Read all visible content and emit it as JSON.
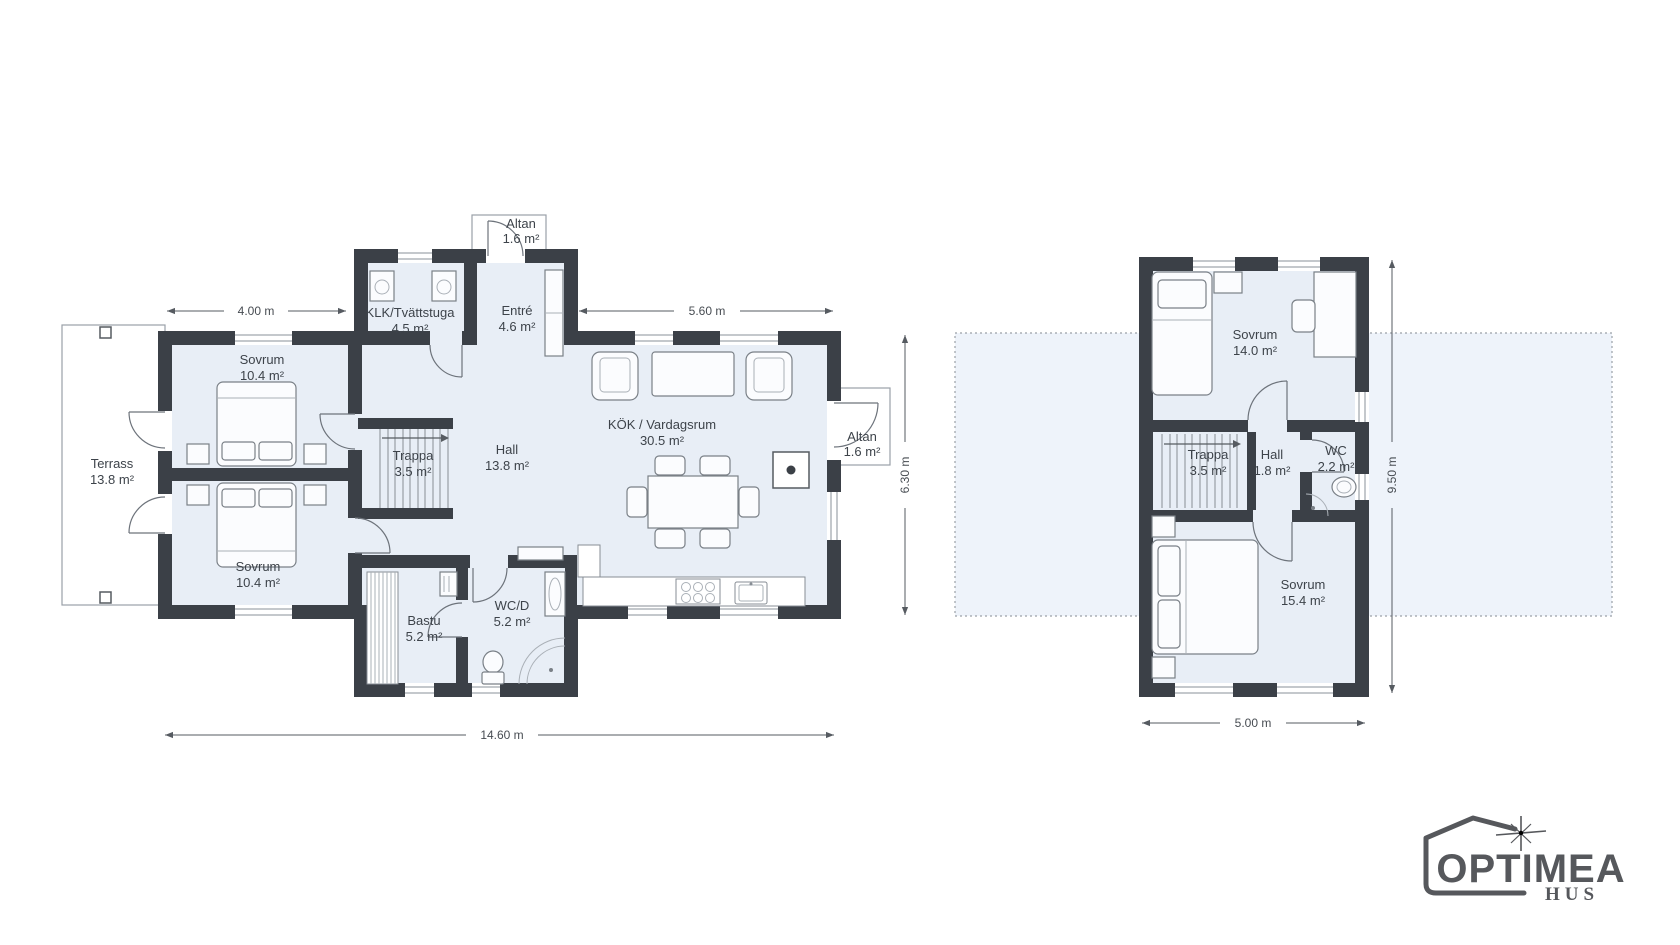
{
  "floor1": {
    "rooms": {
      "terrass": {
        "label": "Terrass",
        "area": "13.8 m²"
      },
      "sovrum_top": {
        "label": "Sovrum",
        "area": "10.4 m²"
      },
      "sovrum_bottom": {
        "label": "Sovrum",
        "area": "10.4 m²"
      },
      "klk": {
        "label": "KLK/Tvättstuga",
        "area": "4.5 m²"
      },
      "entre": {
        "label": "Entré",
        "area": "4.6 m²"
      },
      "altan_top": {
        "label": "Altan",
        "area": "1.6 m²"
      },
      "altan_right": {
        "label": "Altan",
        "area": "1.6 m²"
      },
      "trappa": {
        "label": "Trappa",
        "area": "3.5 m²"
      },
      "hall": {
        "label": "Hall",
        "area": "13.8 m²"
      },
      "kok_vardagsrum": {
        "label": "KÖK / Vardagsrum",
        "area": "30.5 m²"
      },
      "bastu": {
        "label": "Bastu",
        "area": "5.2 m²"
      },
      "wc_d": {
        "label": "WC/D",
        "area": "5.2 m²"
      }
    },
    "dims": {
      "left_top": "4.00 m",
      "right_top": "5.60 m",
      "side": "6.30 m",
      "bottom": "14.60 m"
    }
  },
  "floor2": {
    "rooms": {
      "sovrum_top": {
        "label": "Sovrum",
        "area": "14.0 m²"
      },
      "trappa": {
        "label": "Trappa",
        "area": "3.5 m²"
      },
      "hall": {
        "label": "Hall",
        "area": "1.8 m²"
      },
      "wc": {
        "label": "WC",
        "area": "2.2 m²"
      },
      "sovrum_bottom": {
        "label": "Sovrum",
        "area": "15.4 m²"
      }
    },
    "dims": {
      "side": "9.50 m",
      "bottom": "5.00 m"
    }
  },
  "logo": {
    "brand": "OPTIMEA",
    "sub": "HUS"
  },
  "colors": {
    "wall": "#3b4047",
    "room_fill": "#e8eef6",
    "footprint_fill": "#eef3fa",
    "line": "#6d737b",
    "dim": "#474c52",
    "logo": "#56585c"
  }
}
